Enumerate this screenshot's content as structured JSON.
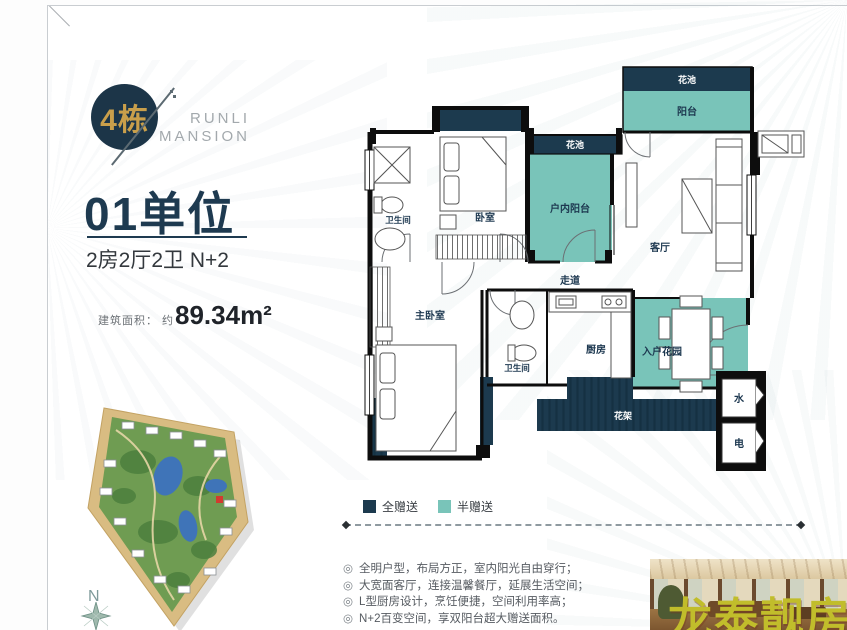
{
  "page": {
    "accent_navy": "#1c3a4e",
    "accent_teal": "#79c4b9",
    "accent_gold": "#c99f4b",
    "watermark_color": "#c1bd2b"
  },
  "left_panel": {
    "building_badge": "4栋",
    "brand_line1": "RUNLI",
    "brand_line2": "MANSION",
    "unit_title": "01单位",
    "unit_spec": "2房2厅2卫 N+2",
    "area_label": "建筑面积：",
    "area_approx": "约",
    "area_value": "89.34m²",
    "compass_north": "N"
  },
  "floor_plan": {
    "rooms": {
      "flower_bed_top": "花池",
      "balcony": "阳台",
      "flower_bed_mid": "花池",
      "indoor_balcony": "户内阳台",
      "bathroom1": "卫生间",
      "bedroom": "卧室",
      "living_room": "客厅",
      "corridor": "走道",
      "master_bedroom": "主卧室",
      "bathroom2": "卫生间",
      "kitchen": "厨房",
      "entrance_garden": "入户花园",
      "flower_rack": "花架",
      "water_meter": "水",
      "electric_meter": "电"
    }
  },
  "legend": {
    "full_gift": "全赠送",
    "half_gift": "半赠送"
  },
  "features": {
    "bullet": "◎",
    "items": [
      "全明户型，布局方正，室内阳光自由穿行；",
      "大宽面客厅，连接温馨餐厅，延展生活空间；",
      "L型厨房设计，烹饪便捷，空间利用率高；",
      "N+2百变空间，享双阳台超大赠送面积。"
    ]
  },
  "watermark": "龙泰靓房"
}
